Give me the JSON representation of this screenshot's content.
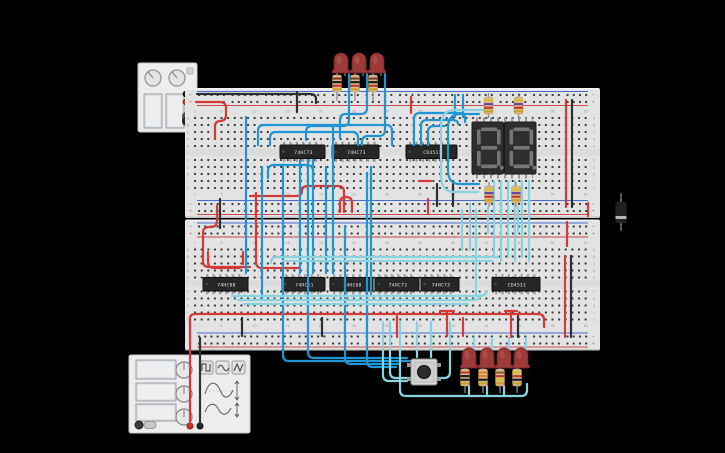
{
  "app": {
    "background": "#000000",
    "canvas_type": "circuit-design-workspace"
  },
  "power_supply": {
    "name": "power-supply",
    "knobs": 2,
    "screens": 2,
    "terminal_colors": [
      "#303030",
      "#d43a3a"
    ]
  },
  "function_generator": {
    "name": "function-generator",
    "screens": 3,
    "knobs": 3,
    "wave_buttons": [
      "square-wave-icon",
      "sine-wave-icon",
      "triangle-wave-icon"
    ],
    "terminal_colors": [
      "#d43a3a",
      "#303030"
    ]
  },
  "breadboard": {
    "count": 2,
    "row_letters": [
      "A",
      "B",
      "C",
      "D",
      "E",
      "F",
      "G",
      "H",
      "I",
      "J"
    ],
    "column_numbers": [
      "1",
      "5",
      "10",
      "15",
      "20",
      "25",
      "30",
      "35",
      "40",
      "45",
      "50",
      "55",
      "60"
    ],
    "rail_minus": "−",
    "rail_plus": "+",
    "body_color": "#e3e3e3",
    "hole_color": "#3f3f3f"
  },
  "ics": {
    "top": [
      {
        "label": "74HC73"
      },
      {
        "label": "74HC73"
      },
      {
        "label": "CD4511"
      }
    ],
    "bottom": [
      {
        "label": "74HC08"
      },
      {
        "label": "74HC11"
      },
      {
        "label": "74HC08"
      },
      {
        "label": "74HC73"
      },
      {
        "label": "74HC73"
      },
      {
        "label": "CD4511"
      }
    ]
  },
  "display": {
    "type": "dual 7-segment display",
    "digits": [
      "8.",
      "8."
    ],
    "state": "off",
    "body_color": "#2e2e2e",
    "segment_color": "#7d7d7d"
  },
  "leds": {
    "top_count": 3,
    "bottom_count": 4,
    "color": "red",
    "body_color": "#9c3a3a"
  },
  "resistors": {
    "body_color": "#d8b98f",
    "top_bands": [
      "#7a3c1e",
      "#1a1a1a",
      "#c0392b",
      "#c9a227"
    ],
    "display_bands": [
      "#d4c02a",
      "#6a3fa0",
      "#c0392b",
      "#c9a227"
    ],
    "bottom_bands": [
      [
        "#c0392b",
        "#1a1a1a",
        "#1a1a1a",
        "#c9a227"
      ],
      [
        "#e67e22",
        "#e67e22",
        "#1a1a1a",
        "#c9a227"
      ],
      [
        "#8a5a2b",
        "#c0392b",
        "#d4c02a",
        "#c9a227"
      ],
      [
        "#d4c02a",
        "#c0392b",
        "#1a1a1a",
        "#c9a227"
      ]
    ]
  },
  "pushbutton": {
    "count": 1,
    "cap_color": "#2b2b2b",
    "base_color": "#d9d9d9"
  },
  "diode": {
    "count": 1,
    "body_color": "#222222",
    "stripe_color": "#b5b5b5"
  },
  "wires": {
    "blue": "#2095d2",
    "cyan": "#8ad2df",
    "red": "#d43a3a",
    "black": "#303030"
  }
}
